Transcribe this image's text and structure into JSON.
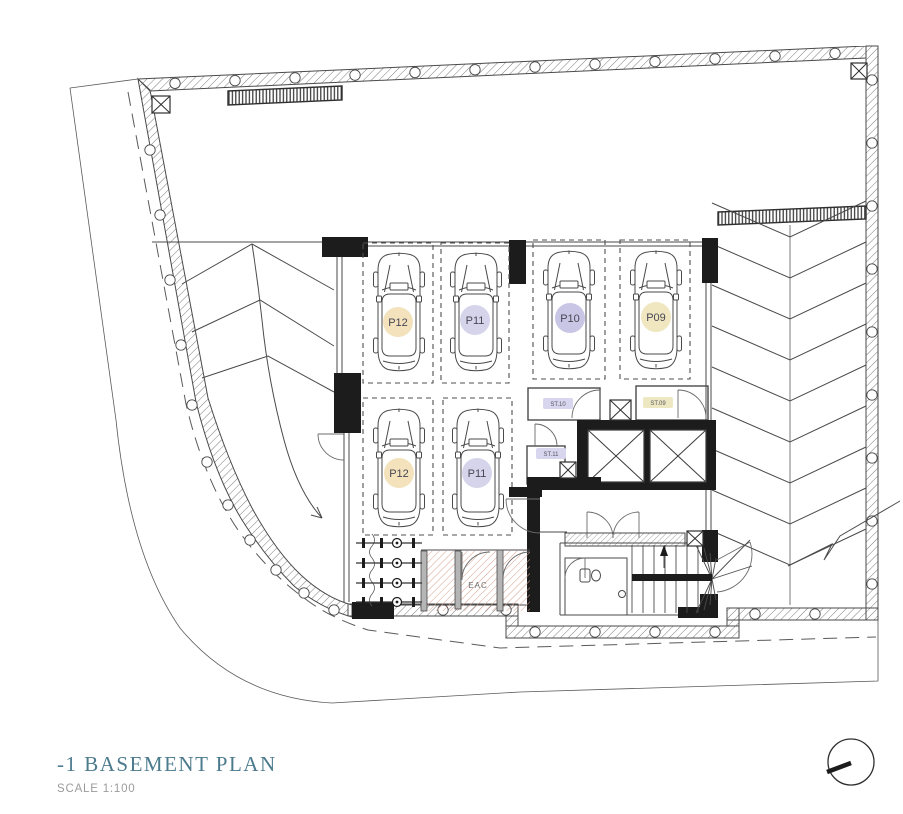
{
  "title_block": {
    "title": "-1 BASEMENT PLAN",
    "scale": "SCALE 1:100"
  },
  "parking_spaces": [
    {
      "label": "P12",
      "row": "top",
      "badge_color": "#f3e2bc"
    },
    {
      "label": "P11",
      "row": "top",
      "badge_color": "#d6d4ea"
    },
    {
      "label": "P10",
      "row": "top",
      "badge_color": "#c8c6e4"
    },
    {
      "label": "P09",
      "row": "top",
      "badge_color": "#f0e6bf"
    },
    {
      "label": "P12",
      "row": "bottom",
      "badge_color": "#f3e2bc"
    },
    {
      "label": "P11",
      "row": "bottom",
      "badge_color": "#d6d4ea"
    }
  ],
  "storage_rooms": [
    {
      "label": "ST.10",
      "badge_color": "#d8d6ee"
    },
    {
      "label": "ST.09",
      "badge_color": "#eee8c2"
    },
    {
      "label": "ST.11",
      "badge_color": "#d8d6ee"
    }
  ],
  "rooms": {
    "eac_label": "EAC"
  },
  "colors": {
    "title_text": "#4d7b8e",
    "scale_text": "#9b9b9b",
    "drawing_line": "#4a4a4a",
    "wall_fill": "#1c1c1c",
    "eac_hatch": "#d9a08f"
  }
}
